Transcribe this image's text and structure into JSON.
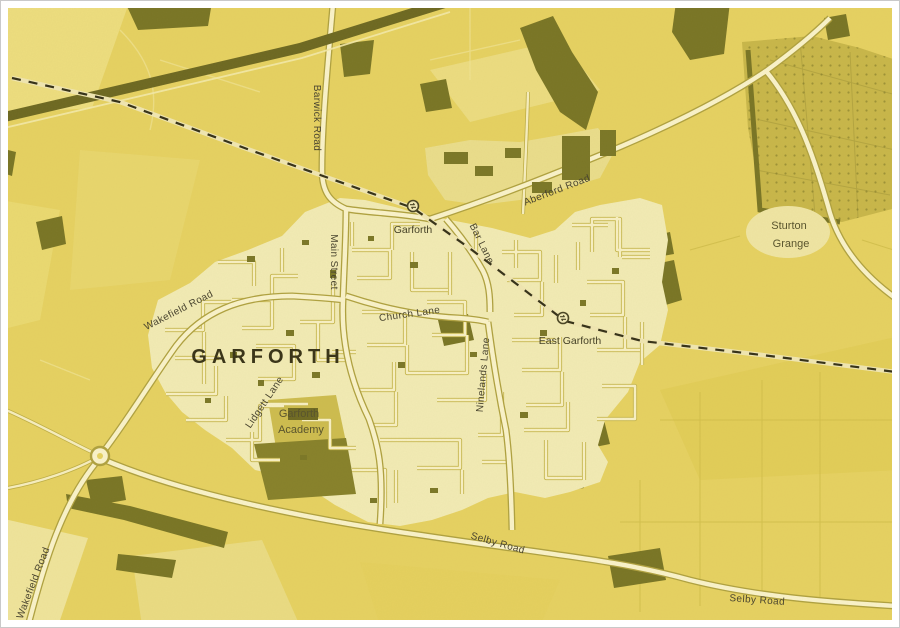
{
  "town": {
    "label": "GARFORTH"
  },
  "places": {
    "academy": {
      "line1": "Garforth",
      "line2": "Academy"
    },
    "sturton_grange": {
      "line1": "Sturton",
      "line2": "Grange"
    }
  },
  "stations": {
    "garforth": {
      "name": "Garforth"
    },
    "east_garforth": {
      "name": "East Garforth"
    }
  },
  "roads": {
    "barwick": "Barwick Road",
    "wakefield": "Wakefield Road",
    "wakefield_sw": "Wakefield Road",
    "main": "Main Street",
    "church": "Church Lane",
    "lidgett": "Lidgett Lane",
    "aberford": "Aberford Road",
    "bar": "Bar Lane",
    "ninelands": "Ninelands Lane",
    "selby": "Selby Road",
    "selby_east": "Selby Road"
  },
  "icons": {
    "station_icon": "national-rail-station"
  },
  "colors": {
    "map_background": "#e4cf63",
    "built_up_area": "#f2ecc0",
    "road_fill": "#fbf5d8",
    "road_casing": "#a89a3e",
    "woodland_dark": "#6b6820",
    "plantation": "#c3b149",
    "railway": "#1e1c12",
    "label_text": "#33302a",
    "frame": "#ffffff"
  }
}
